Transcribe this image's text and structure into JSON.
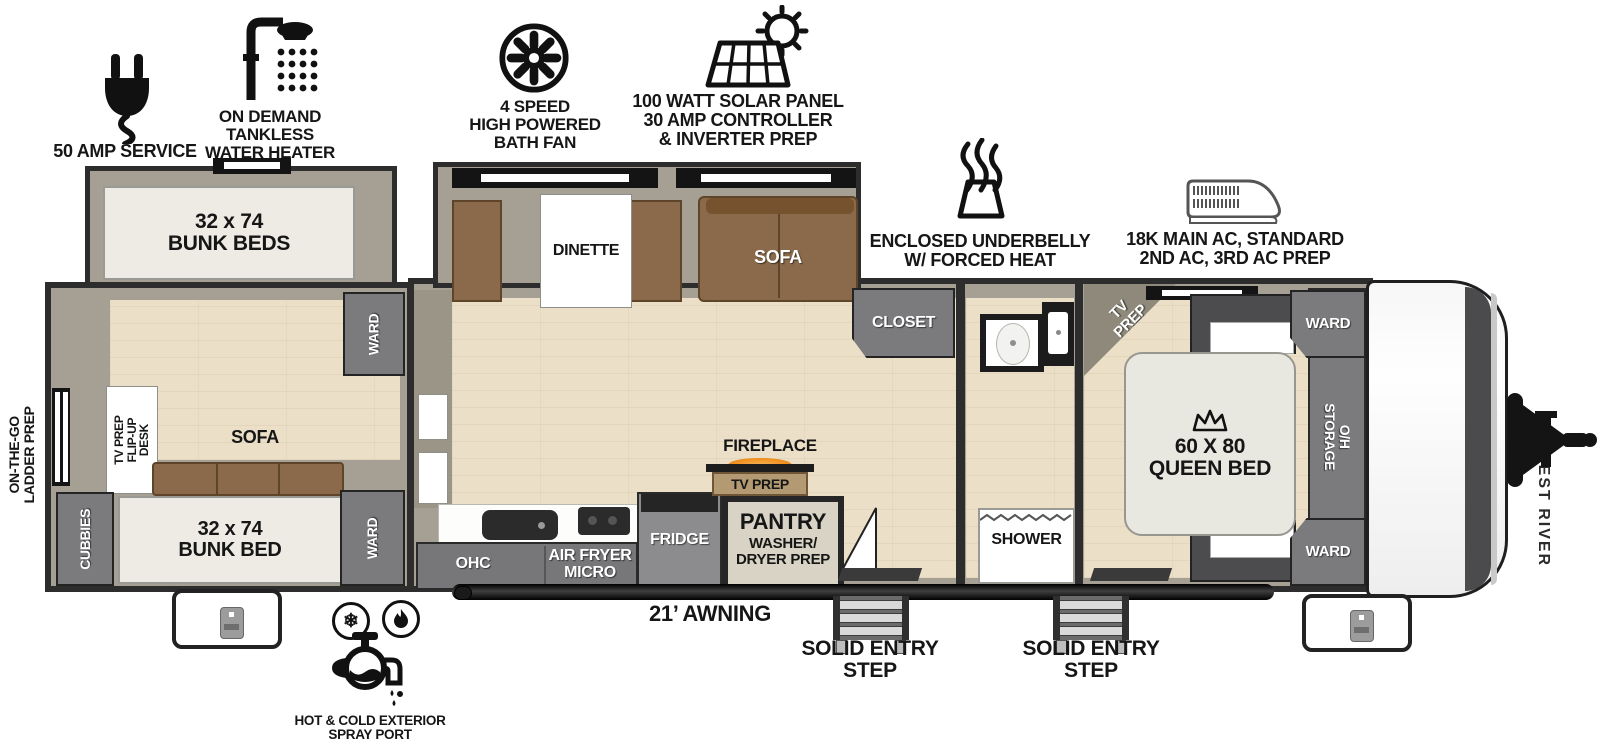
{
  "callouts": {
    "amp_service": "50 AMP SERVICE",
    "water_heater": "ON DEMAND\nTANKLESS\nWATER HEATER",
    "bath_fan": "4 SPEED\nHIGH POWERED\nBATH FAN",
    "solar": "100 WATT SOLAR PANEL\n30 AMP CONTROLLER\n& INVERTER PREP",
    "underbelly": "ENCLOSED UNDERBELLY\nW/ FORCED HEAT",
    "ac": "18K MAIN AC, STANDARD\n2ND AC, 3RD AC PREP",
    "ladder_prep": "ON-THE-GO\nLADDER PREP",
    "spray_port": "HOT & COLD EXTERIOR\nSPRAY PORT",
    "awning": "21’ AWNING",
    "entry_step": "SOLID ENTRY\nSTEP"
  },
  "rear_room": {
    "bunk_beds": "32 x 74\nBUNK BEDS",
    "bunk_bed": "32 x 74\nBUNK BED",
    "sofa": "SOFA",
    "cubbies": "CUBBIES",
    "ward_top": "WARD",
    "ward_bottom": "WARD",
    "tv_desk": "TV PREP\nFLIP-UP DESK"
  },
  "living": {
    "dinette": "DINETTE",
    "sofa": "SOFA",
    "closet": "CLOSET",
    "ohc": "OHC",
    "air_fryer_micro": "AIR FRYER\nMICRO",
    "fridge": "FRIDGE",
    "pantry_title": "PANTRY",
    "pantry_sub": "WASHER/\nDRYER PREP",
    "fireplace": "FIREPLACE",
    "fireplace_tv": "TV PREP"
  },
  "bath": {
    "shower": "SHOWER"
  },
  "bedroom": {
    "tv_prep": "TV\nPREP",
    "queen_bed": "60 X 80\nQUEEN BED",
    "ward_top": "WARD",
    "ward_bottom": "WARD",
    "oh_storage": "O/H STORAGE"
  },
  "exterior": {
    "brand": "FOREST RIVER"
  },
  "colors": {
    "body_outline": "#2d2d2d",
    "interior_wall": "#a5a093",
    "floor": "#ebdfc7",
    "storage_gray": "#7b7b7e",
    "sofa_brown": "#8a6a4b",
    "fireplace_orange": "#f29422",
    "mattress": "#edebe3"
  }
}
